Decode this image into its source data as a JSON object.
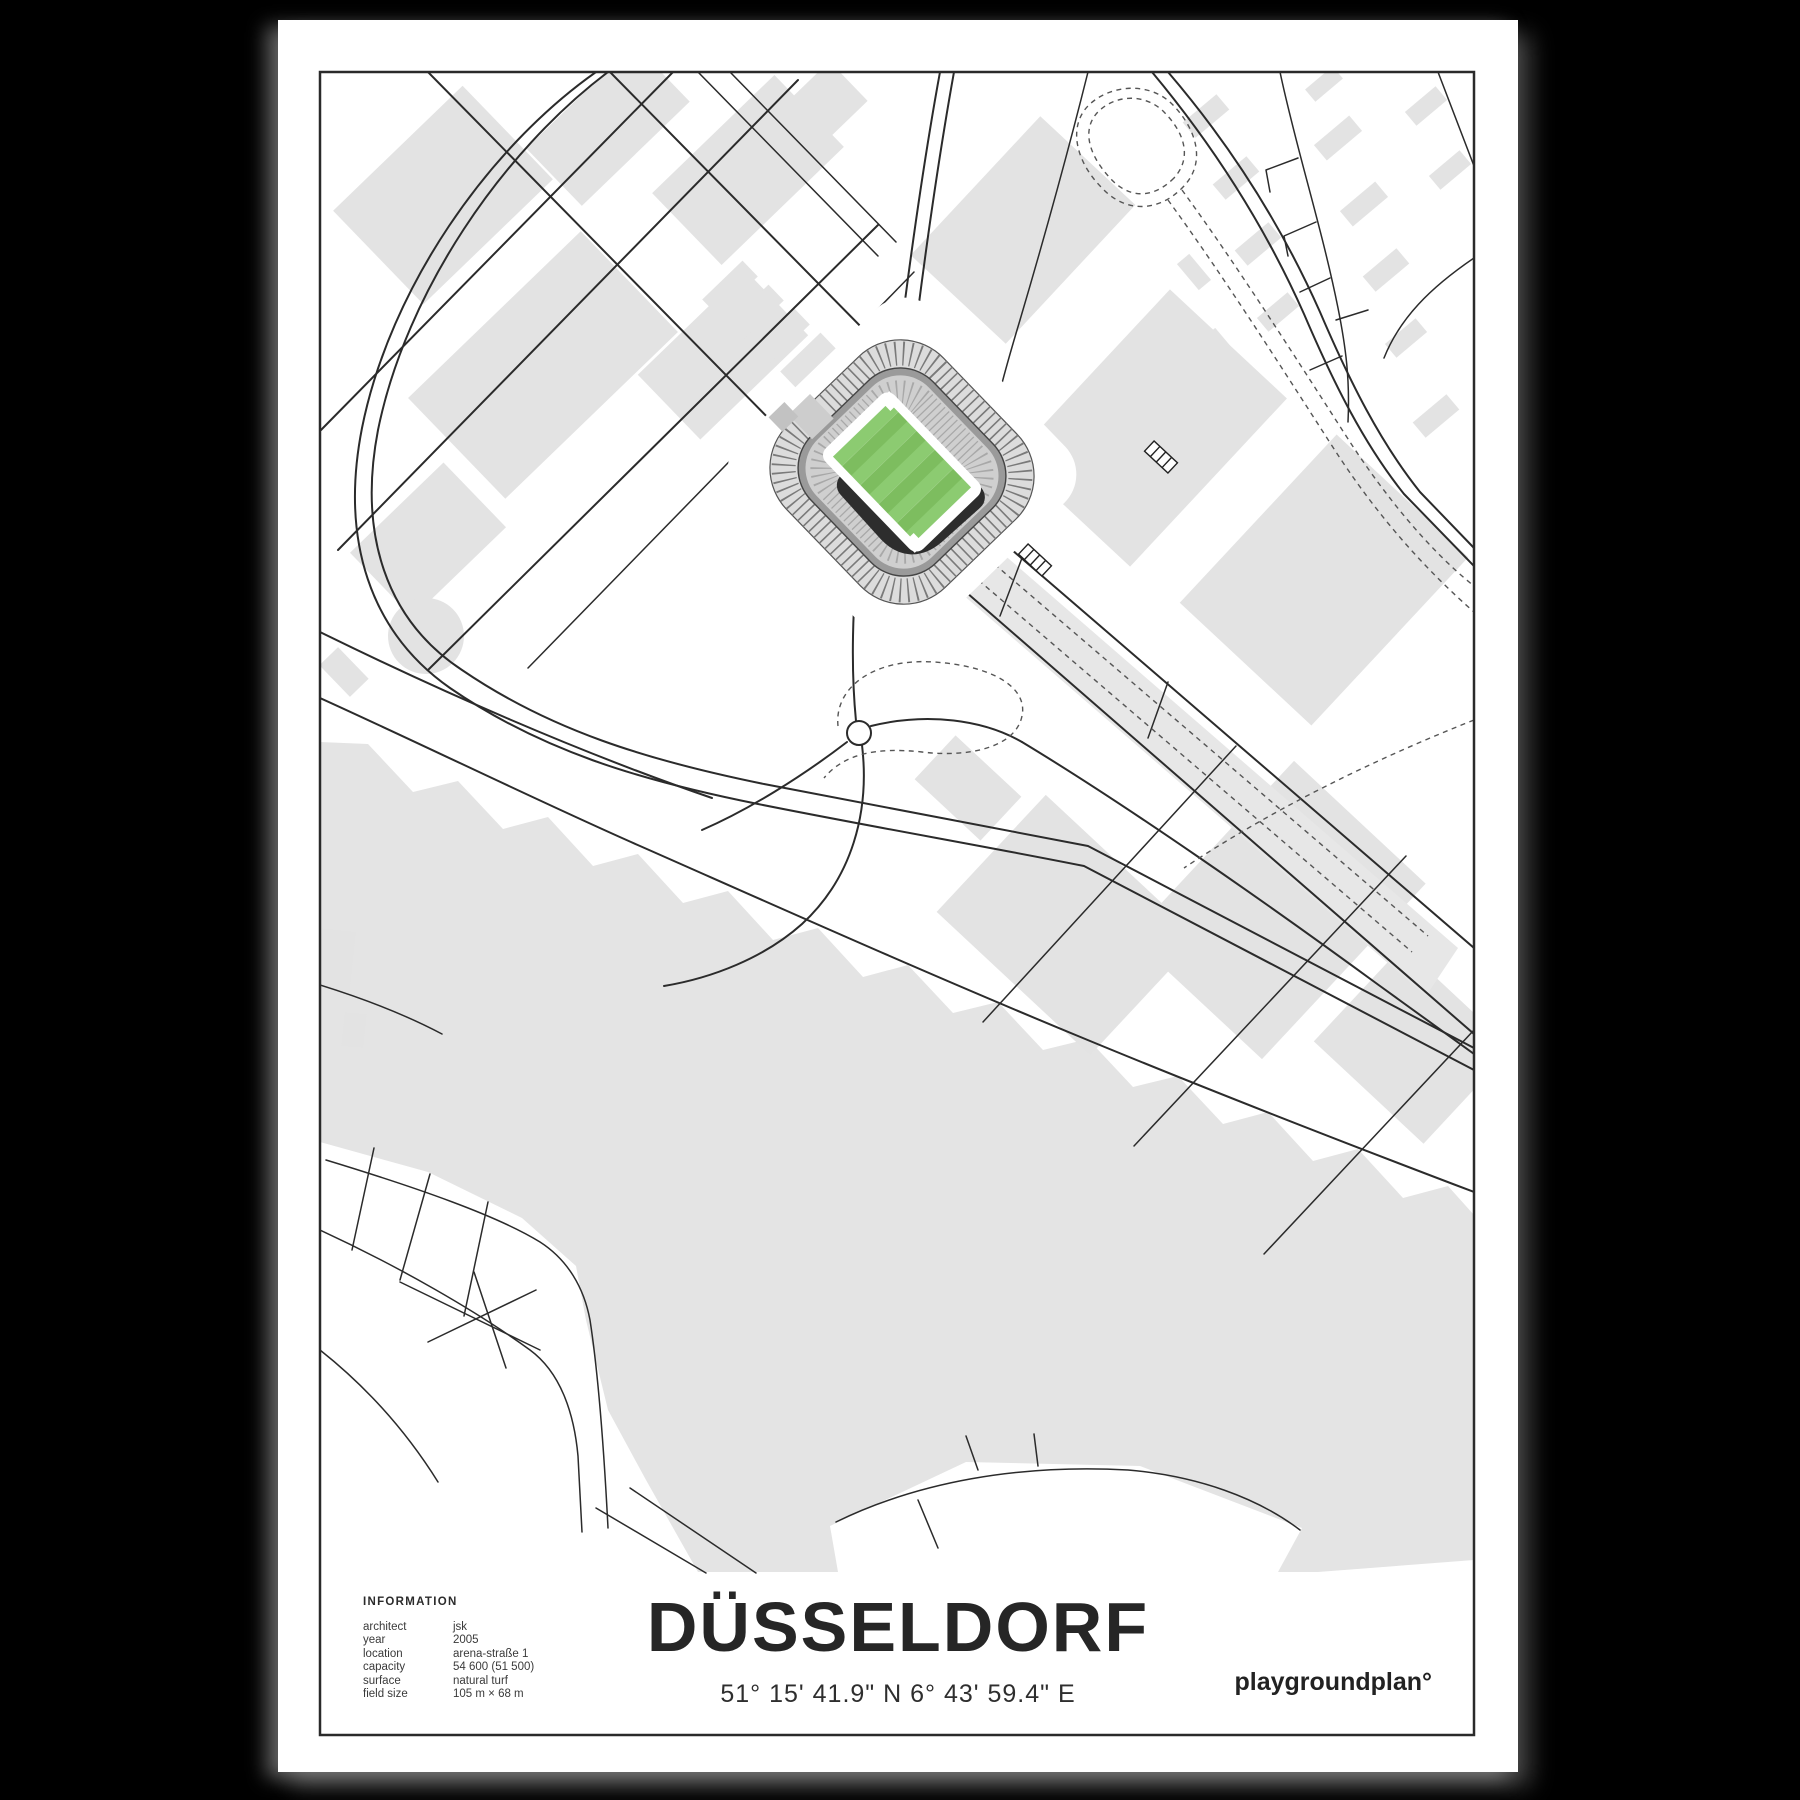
{
  "poster": {
    "title": "DÜSSELDORF",
    "coordinates": "51° 15' 41.9\" N  6° 43' 59.4\" E",
    "brand": "playgroundplan°",
    "information": {
      "heading": "INFORMATION",
      "rows": [
        {
          "label": "architect",
          "value": "jsk"
        },
        {
          "label": "year",
          "value": "2005"
        },
        {
          "label": "location",
          "value": "arena-straße 1"
        },
        {
          "label": "capacity",
          "value": "54 600 (51 500)"
        },
        {
          "label": "surface",
          "value": "natural turf"
        },
        {
          "label": "field size",
          "value": "105 m × 68 m"
        }
      ]
    }
  },
  "map": {
    "type": "stadium-location-map",
    "stadium": "arena at coordinates shown",
    "colors": {
      "background_land": "#ffffff",
      "water_and_buildings": "#e4e4e4",
      "roads": "#2b2b2b",
      "tram_dashed": "#555555",
      "pitch_stripe_light": "#8ccb71",
      "pitch_stripe_dark": "#7dbd5f",
      "stand_dark": "#2d2d2d",
      "stand_light": "#cfcfcf"
    }
  }
}
